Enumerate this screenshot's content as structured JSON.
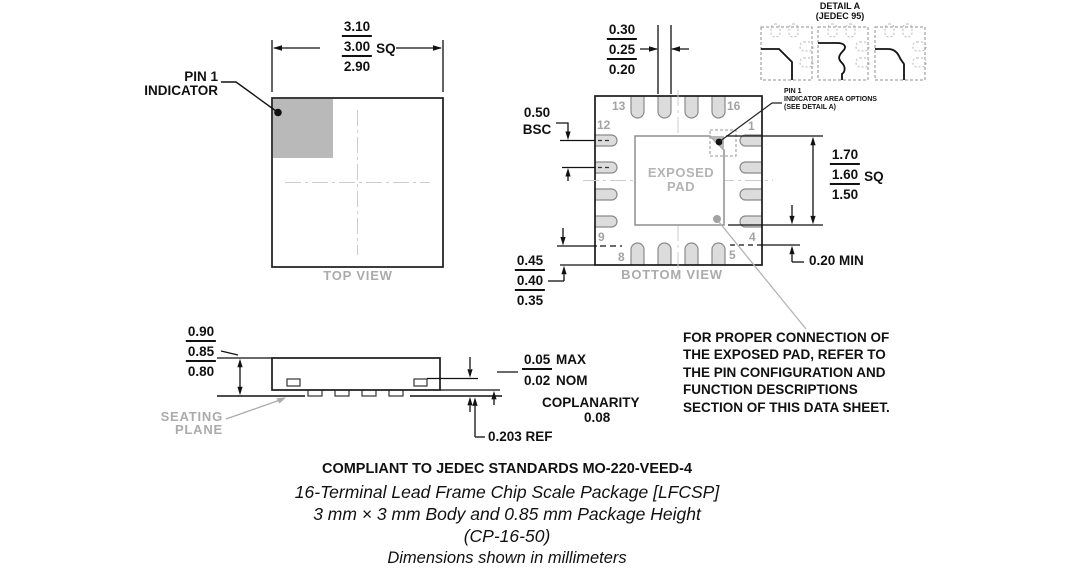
{
  "top_view": {
    "label": "TOP VIEW",
    "pin1_label_line1": "PIN 1",
    "pin1_label_line2": "INDICATOR",
    "dim_body": {
      "max": "3.10",
      "nom": "3.00",
      "suffix": "SQ",
      "min": "2.90"
    }
  },
  "bottom_view": {
    "label": "BOTTOM VIEW",
    "exposed_pad_line1": "EXPOSED",
    "exposed_pad_line2": "PAD",
    "pin_numbers": {
      "p13": "13",
      "p16": "16",
      "p12": "12",
      "p9": "9",
      "p8": "8",
      "p5": "5",
      "p1": "1",
      "p4": "4"
    },
    "dim_terminal_width": {
      "max": "0.30",
      "nom": "0.25",
      "min": "0.20"
    },
    "dim_pitch": {
      "value": "0.50",
      "qualifier": "BSC"
    },
    "dim_terminal_length": {
      "max": "0.45",
      "nom": "0.40",
      "min": "0.35"
    },
    "dim_exposed_pad": {
      "max": "1.70",
      "nom": "1.60",
      "suffix": "SQ",
      "min": "1.50"
    },
    "dim_pad_clearance": "0.20 MIN",
    "pin1_note_line1": "PIN 1",
    "pin1_note_line2": "INDICATOR AREA OPTIONS",
    "pin1_note_line3": "(SEE DETAIL A)"
  },
  "detail_a": {
    "title_line1": "DETAIL A",
    "title_line2": "(JEDEC 95)"
  },
  "side_view": {
    "dim_height": {
      "max": "0.90",
      "nom": "0.85",
      "min": "0.80"
    },
    "seating_line1": "SEATING",
    "seating_line2": "PLANE",
    "dim_standoff": {
      "max_value": "0.05",
      "max_unit": "MAX",
      "nom_value": "0.02",
      "nom_unit": "NOM"
    },
    "coplanarity_label": "COPLANARITY",
    "coplanarity_value": "0.08",
    "dim_lead_thickness": "0.203 REF"
  },
  "note": {
    "lines": [
      "FOR PROPER CONNECTION OF",
      "THE EXPOSED PAD, REFER TO",
      "THE PIN CONFIGURATION AND",
      "FUNCTION DESCRIPTIONS",
      "SECTION OF THIS DATA SHEET."
    ]
  },
  "footer": {
    "compliance": "COMPLIANT TO JEDEC STANDARDS MO-220-VEED-4",
    "package_name": "16-Terminal Lead Frame Chip Scale Package [LFCSP]",
    "body_size": "3 mm × 3 mm Body and 0.85 mm Package Height",
    "package_code": "(CP-16-50)",
    "units_note": "Dimensions shown in millimeters"
  },
  "colors": {
    "line": "#111111",
    "gray_label": "#ababab",
    "pin_fill": "#dcdcdc"
  }
}
